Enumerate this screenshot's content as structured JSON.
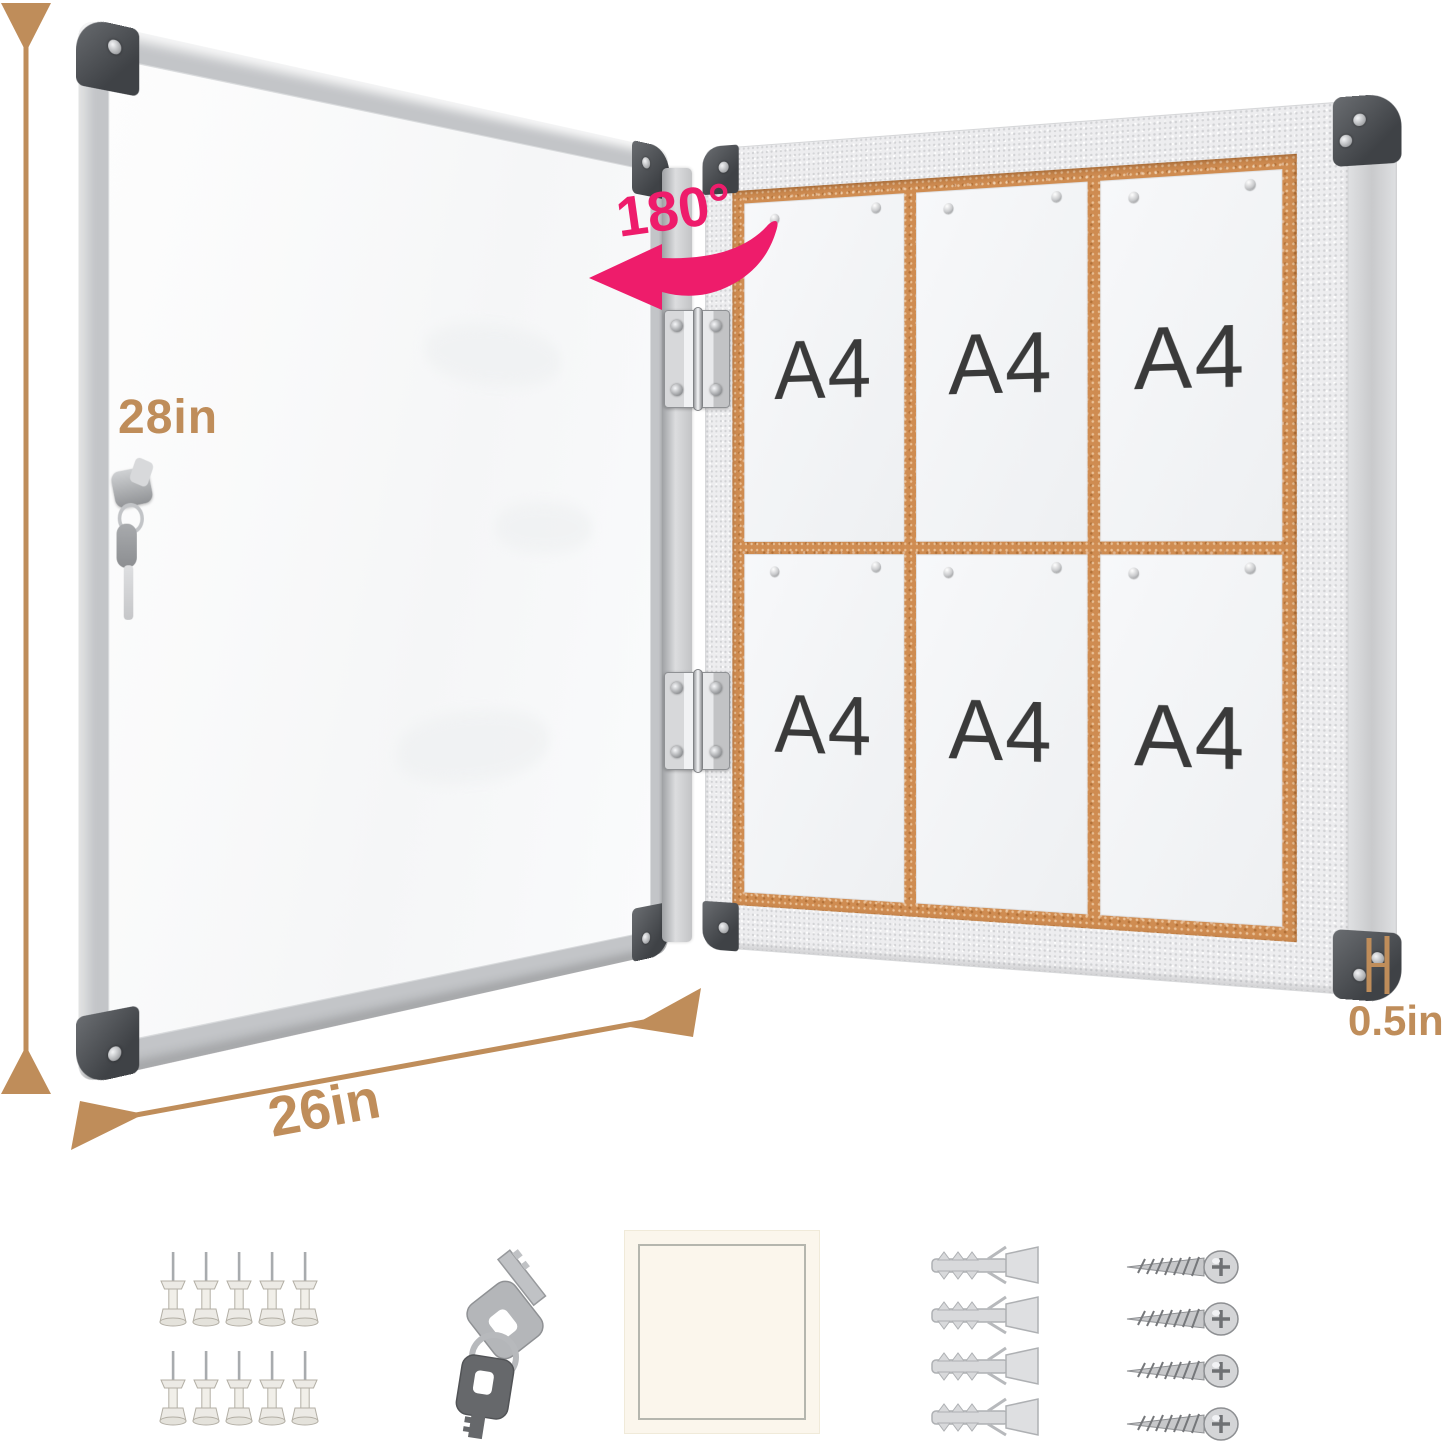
{
  "annotations": {
    "height": "28in",
    "width": "26in",
    "depth": "0.5in",
    "open_angle": "180°"
  },
  "board": {
    "papers": [
      {
        "label": "A4"
      },
      {
        "label": "A4"
      },
      {
        "label": "A4"
      },
      {
        "label": "A4"
      },
      {
        "label": "A4"
      },
      {
        "label": "A4"
      }
    ]
  },
  "accessories": [
    {
      "name": "push-pins",
      "count": 10
    },
    {
      "name": "keys",
      "count": 2
    },
    {
      "name": "adhesive-pad",
      "count": 1
    },
    {
      "name": "wall-anchors",
      "count": 4
    },
    {
      "name": "screws",
      "count": 4
    }
  ],
  "colors": {
    "annotation_tan": "#bf8d5a",
    "accent_pink": "#ee1c6b",
    "cork": "#cf8c51",
    "frame_silver": "#c3c5c8",
    "cabinet_frame": "#ededef",
    "corner_cap": "#4a4d51"
  }
}
